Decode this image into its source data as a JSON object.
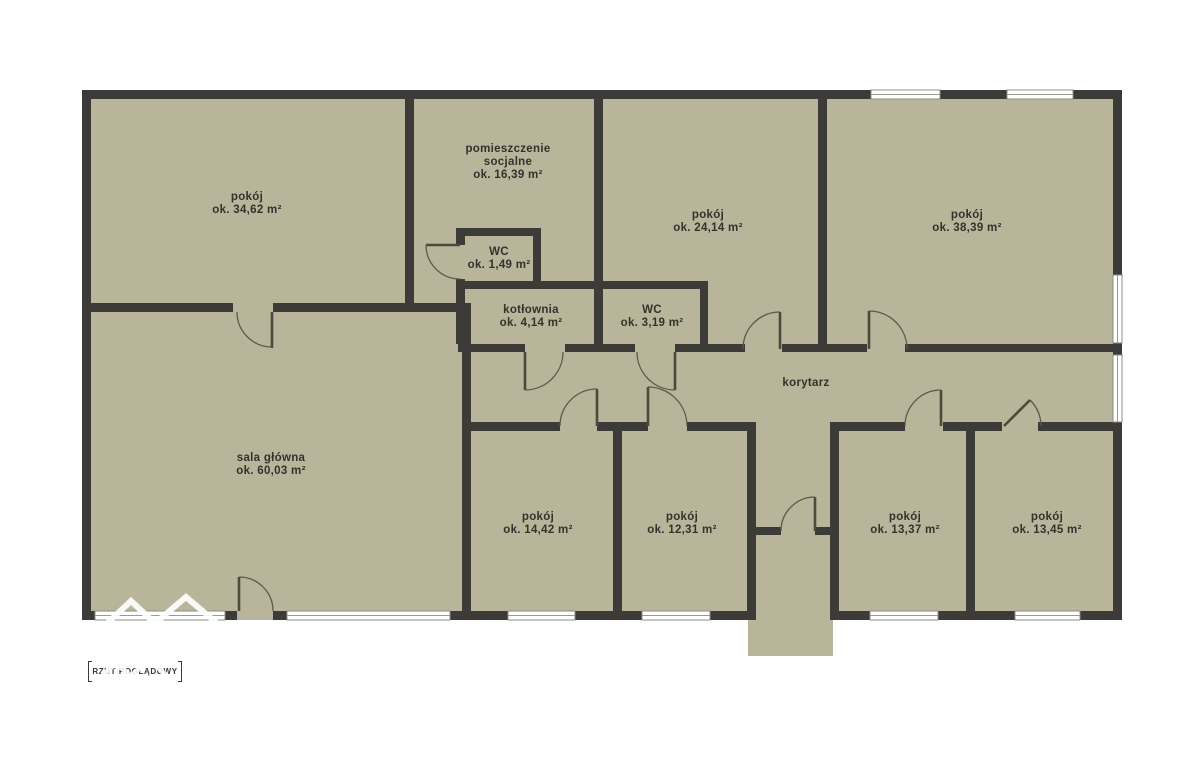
{
  "theme": {
    "background": "#ffffff",
    "plan_fill": "#b8b59b",
    "wall_color": "#3c3b37",
    "window_color": "#ffffff",
    "door_line_color": "#4c4a3c",
    "text_color": "#33322c"
  },
  "badge": {
    "label": "RZUT POGLĄDOWY"
  },
  "rooms": [
    {
      "id": "pokoj-nw",
      "name_lines": [
        "pokój"
      ],
      "area": "ok. 34,62 m²",
      "x": 247,
      "y": 200
    },
    {
      "id": "pomieszczenie-socjalne",
      "name_lines": [
        "pomieszczenie",
        "socjalne"
      ],
      "area": "ok. 16,39 m²",
      "x": 508,
      "y": 152
    },
    {
      "id": "pokoj-n",
      "name_lines": [
        "pokój"
      ],
      "area": "ok. 24,14 m²",
      "x": 708,
      "y": 218
    },
    {
      "id": "pokoj-ne",
      "name_lines": [
        "pokój"
      ],
      "area": "ok. 38,39 m²",
      "x": 967,
      "y": 218
    },
    {
      "id": "wc-male",
      "name_lines": [
        "WC"
      ],
      "area": "ok. 1,49 m²",
      "x": 499,
      "y": 255
    },
    {
      "id": "kotlownia",
      "name_lines": [
        "kotłownia"
      ],
      "area": "ok. 4,14 m²",
      "x": 531,
      "y": 313
    },
    {
      "id": "wc",
      "name_lines": [
        "WC"
      ],
      "area": "ok. 3,19 m²",
      "x": 652,
      "y": 313
    },
    {
      "id": "korytarz",
      "name_lines": [
        "korytarz"
      ],
      "area": "",
      "x": 806,
      "y": 386
    },
    {
      "id": "sala-glowna",
      "name_lines": [
        "sala główna"
      ],
      "area": "ok. 60,03 m²",
      "x": 271,
      "y": 461
    },
    {
      "id": "pokoj-s1",
      "name_lines": [
        "pokój"
      ],
      "area": "ok. 14,42 m²",
      "x": 538,
      "y": 520
    },
    {
      "id": "pokoj-s2",
      "name_lines": [
        "pokój"
      ],
      "area": "ok. 12,31 m²",
      "x": 682,
      "y": 520
    },
    {
      "id": "pokoj-s3",
      "name_lines": [
        "pokój"
      ],
      "area": "ok. 13,37 m²",
      "x": 905,
      "y": 520
    },
    {
      "id": "pokoj-s4",
      "name_lines": [
        "pokój"
      ],
      "area": "ok. 13,45 m²",
      "x": 1047,
      "y": 520
    }
  ]
}
